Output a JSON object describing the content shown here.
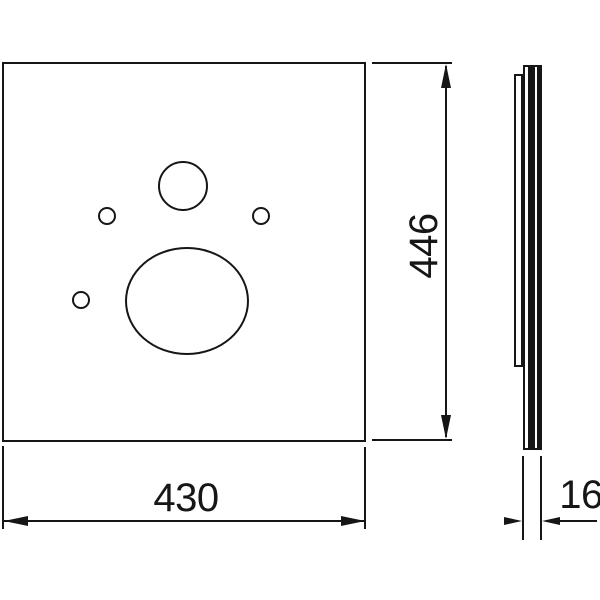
{
  "palette": {
    "ink": "#161616",
    "paper": "#ffffff"
  },
  "drawing": {
    "type": "technical-dimension-drawing",
    "views": {
      "front": "front-view-plate-with-holes",
      "side": "side-profile-view"
    }
  },
  "dimensions": {
    "width": "430",
    "height": "446",
    "depth": "16"
  }
}
